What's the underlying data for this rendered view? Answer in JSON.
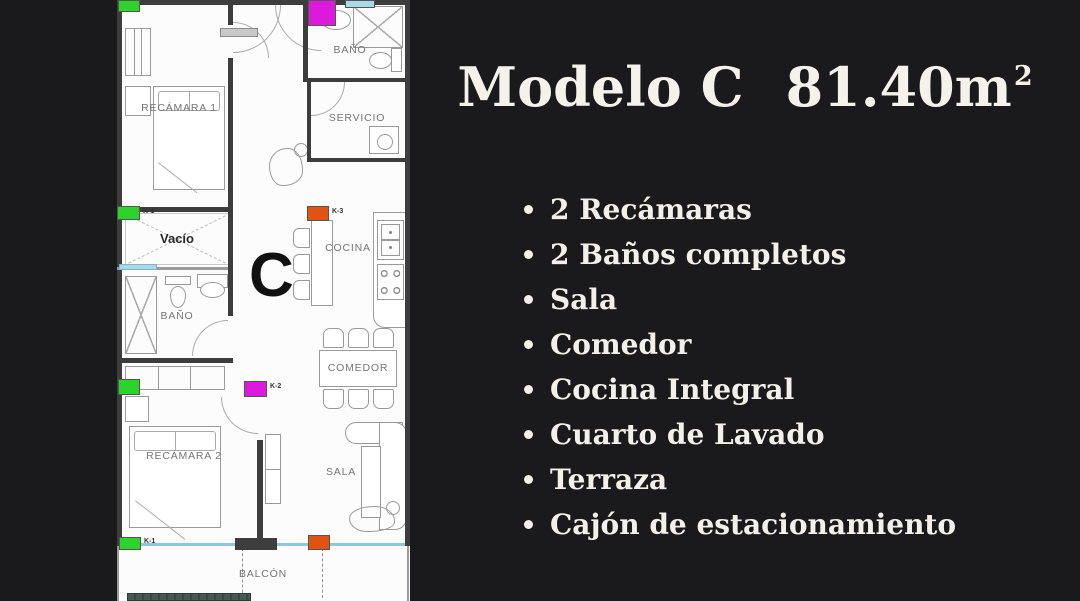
{
  "background_color": "#1a191b",
  "panel": {
    "title_model": "Modelo C",
    "title_area": "81.40m",
    "title_area_sup": "2",
    "text_color": "#f5f2ec",
    "features": [
      "2 Recámaras",
      "2 Baños completos",
      "Sala",
      "Comedor",
      "Cocina Integral",
      "Cuarto de Lavado",
      "Terraza",
      "Cajón de estacionamiento"
    ]
  },
  "floorplan": {
    "letter": "C",
    "rooms": {
      "recamara1": "RECÁMARA 1",
      "bano1": "BAÑO",
      "servicio": "SERVICIO",
      "cocina": "COCINA",
      "vacio": "Vacío",
      "bano2": "BAÑO",
      "comedor": "COMEDOR",
      "recamara2": "RECÁMARA 2",
      "sala": "SALA",
      "balcon": "BALCÓN"
    },
    "markers": {
      "k1": "K-1",
      "k2": "K-2",
      "k3": "K-3"
    },
    "colors": {
      "marker_green": "#2bd32b",
      "marker_magenta": "#dc1adc",
      "marker_orange": "#e25312",
      "marker_blue": "#a9d8e9",
      "balcony_line": "#8ec6dc",
      "hedge_green": "#4a5a50"
    }
  }
}
